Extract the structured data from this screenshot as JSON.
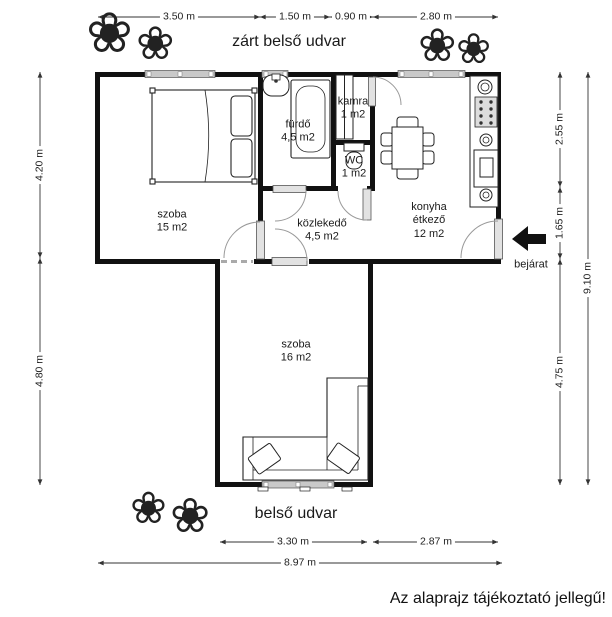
{
  "plan": {
    "labels": {
      "courtyard_top": "zárt belső udvar",
      "courtyard_bottom": "belső udvar",
      "entrance": "bejárat",
      "disclaimer": "Az alaprajz tájékoztató jellegű!"
    },
    "rooms": {
      "szoba15": {
        "name": "szoba",
        "area": "15 m2"
      },
      "furdo": {
        "name": "fürdő",
        "area": "4,5 m2"
      },
      "kamra": {
        "name": "kamra",
        "area": "1 m2"
      },
      "wc": {
        "name": "WC",
        "area": "1 m2"
      },
      "kozlekedo": {
        "name": "közlekedő",
        "area": "4,5 m2"
      },
      "konyha": {
        "name": "konyha étkező",
        "area": "12 m2"
      },
      "szoba16": {
        "name": "szoba",
        "area": "16 m2"
      }
    },
    "dimensions": {
      "top": [
        "3.50 m",
        "1.50 m",
        "0.90 m",
        "2.80 m"
      ],
      "left": [
        "4.20 m",
        "4.80 m"
      ],
      "right": [
        "2.55 m",
        "1.65 m",
        "4.75 m"
      ],
      "right_total": "9.10 m",
      "bottom": [
        "3.30 m",
        "2.87 m"
      ],
      "bottom_total": "8.97 m"
    },
    "icons": {
      "plant_glyph": "❀"
    },
    "colors": {
      "wall": "#111111",
      "window": "#c9c9c9",
      "text": "#1a1a1a"
    }
  }
}
